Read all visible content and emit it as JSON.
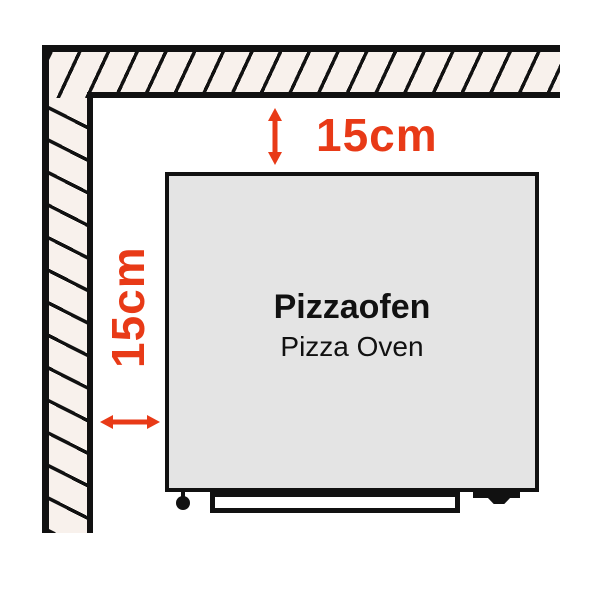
{
  "diagram": {
    "oven": {
      "title": "Pizzaofen",
      "subtitle": "Pizza Oven"
    },
    "clearances": {
      "top": "15cm",
      "left": "15cm"
    },
    "colors": {
      "accent": "#e83a17",
      "wall_fill": "#f8f1ec",
      "oven_fill": "#e4e4e4",
      "line": "#111111"
    }
  }
}
